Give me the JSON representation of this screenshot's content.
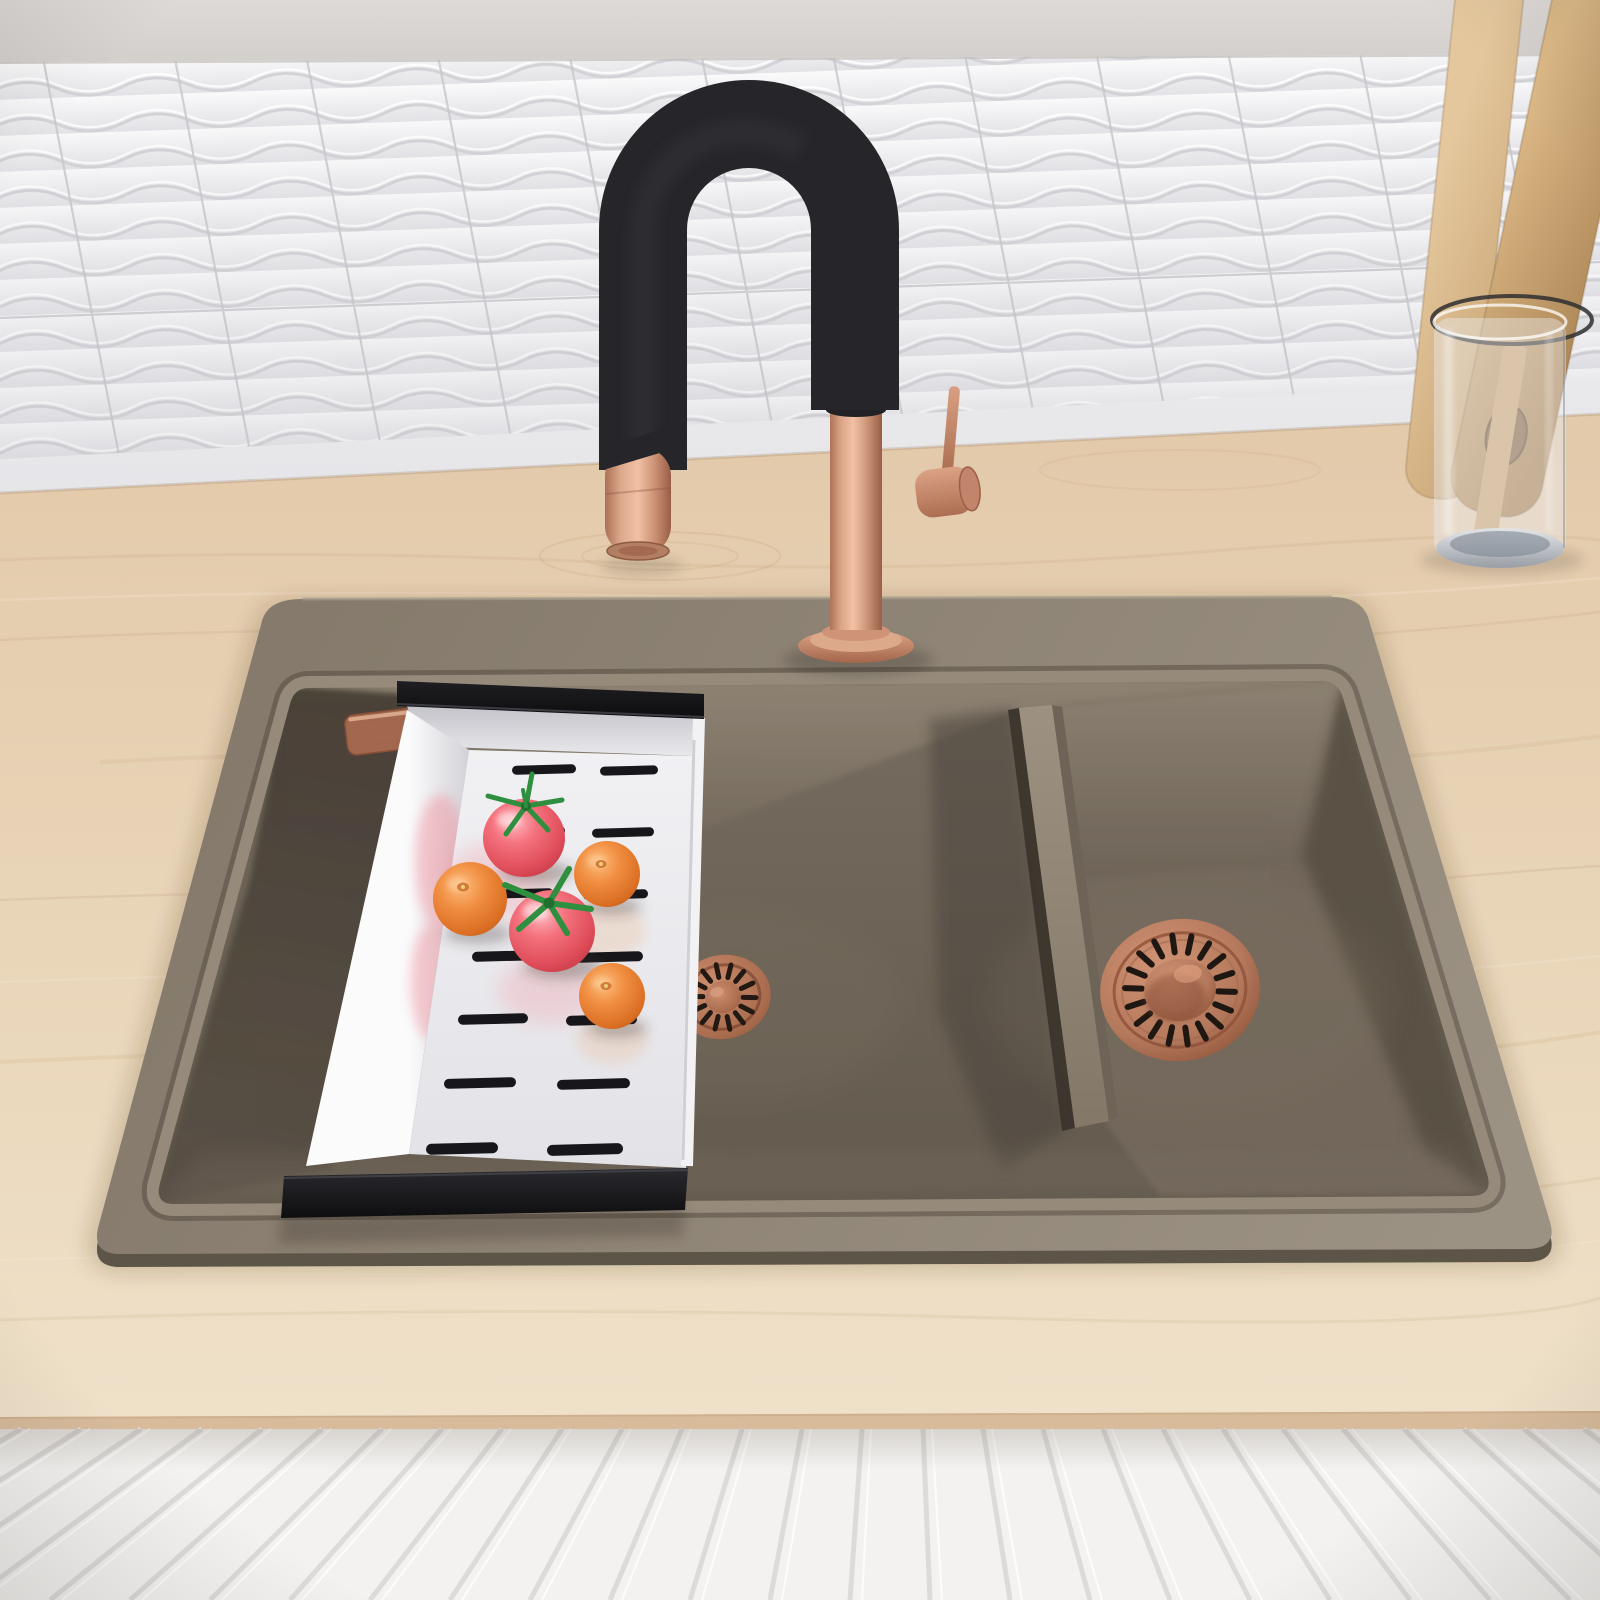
{
  "meta": {
    "kind": "product-render",
    "subject": "double-bowl granite kitchen sink with copper accents"
  },
  "palette": {
    "wall": "#d7d3d0",
    "tile": "#f2f2f4",
    "tile_shadow": "#d2d2d7",
    "grout": "#c6c6cb",
    "wood": "#e7d2b4",
    "wood_edge": "#d7bb9b",
    "cabinet": "#f3f2f0",
    "slat": "#dcdbd9",
    "deck": "#8c8172",
    "deck_light": "#9a9082",
    "basin": "#675d51",
    "basin_dark": "#4a423a",
    "back_wall": "#8d8272",
    "divider": "#9b9080",
    "faucet_black": "#26262a",
    "copper": "#cf987b",
    "copper_light": "#f0bfa3",
    "copper_dark": "#96583f",
    "tray_white": "#f1f1f4",
    "tray_shadow": "#cdcdd4",
    "slot": "#17171b",
    "tomato": "#f4717d",
    "tomato_dark": "#c13a46",
    "stem_green": "#2e8f3f",
    "orange": "#f08d40",
    "orange_dark": "#bf5c1a",
    "glass": "#eceff4",
    "chrome": "#99a0aa"
  },
  "objects": {
    "backsplash": {
      "style": "white-3d-wave-tiles"
    },
    "countertop": {
      "material": "light-wood"
    },
    "cabinet_front": {
      "style": "white-fluted-slats"
    },
    "sink": {
      "bowls": 2,
      "color": "taupe-granite",
      "drains": "copper-strainer"
    },
    "faucet": {
      "type": "pull-down",
      "hose_color": "matte-black",
      "body_color": "brushed-copper"
    },
    "colander_tray": {
      "color": "white",
      "handles": "black",
      "contents": {
        "tomatoes": 2,
        "tangerines": 3
      }
    },
    "utensil_holder": {
      "vessel": "glass-cylinder",
      "contents": "wooden-utensils"
    }
  }
}
